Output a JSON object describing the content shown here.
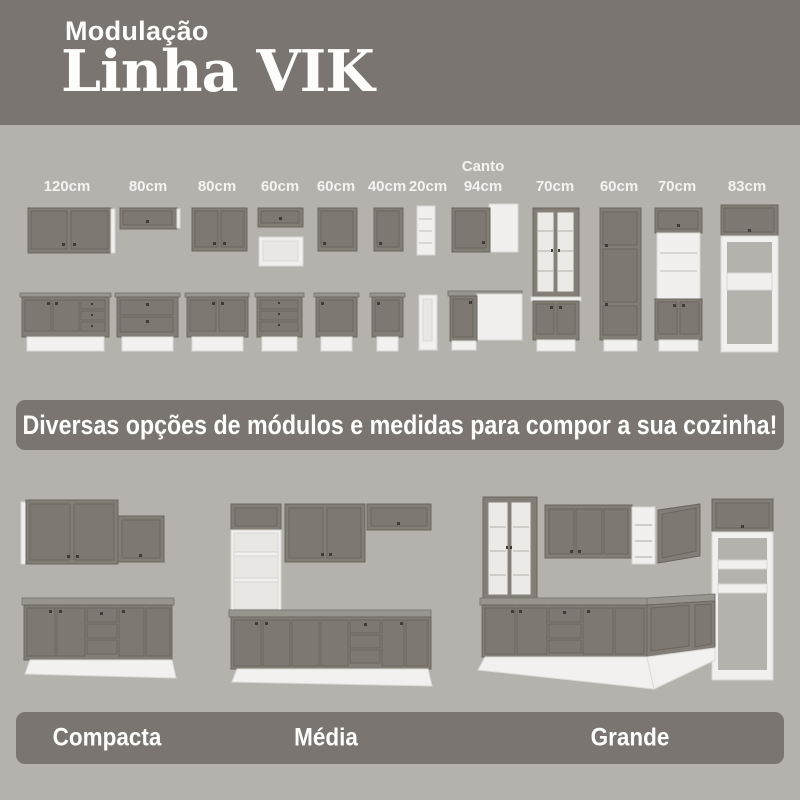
{
  "header": {
    "kicker": "Modulação",
    "title": "Linha VIK"
  },
  "modules": [
    {
      "label": "120cm"
    },
    {
      "label": "80cm"
    },
    {
      "label": "80cm"
    },
    {
      "label": "60cm"
    },
    {
      "label": "60cm"
    },
    {
      "label": "40cm"
    },
    {
      "label": "20cm"
    },
    {
      "label": "Canto\n94cm"
    },
    {
      "label": "70cm"
    },
    {
      "label": "60cm"
    },
    {
      "label": "70cm"
    },
    {
      "label": "83cm"
    }
  ],
  "banner": {
    "text": "Diversas opções de módulos e medidas para compor a sua cozinha!"
  },
  "kitchen_sizes": [
    {
      "name": "Compacta"
    },
    {
      "name": "Média"
    },
    {
      "name": "Grande"
    }
  ],
  "colors": {
    "page_background": "#b5b2ad",
    "band": "#7a7571",
    "cabinet_gray": "#827d76",
    "cabinet_frame": "#6b665f",
    "cabinet_white": "#f1f0ee",
    "text": "#fdfdfc"
  }
}
